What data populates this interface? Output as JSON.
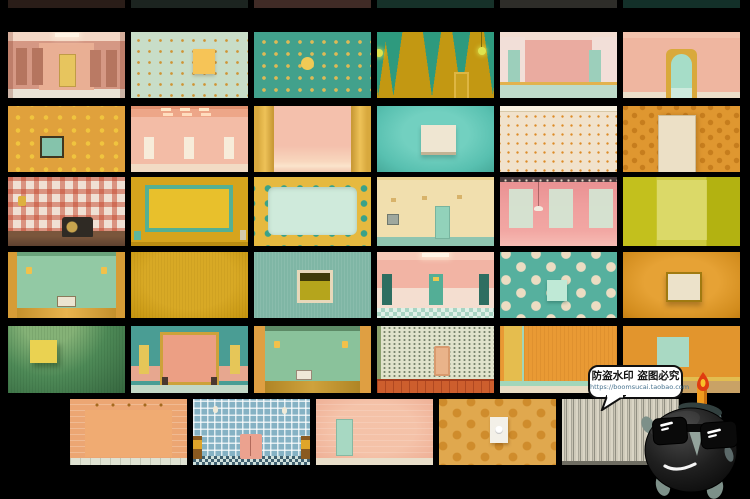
{
  "page": {
    "background": "#000000"
  },
  "watermark": {
    "line1": "防盗水印 盗图必究",
    "line2": "https://boomsucai.taobao.com",
    "bubble_fill": "#ffffff",
    "bubble_border": "#101010",
    "url_color": "#48738f"
  },
  "mascot": {
    "alt": "cartoon bomb mascot wearing sunglasses with lit candle fuse",
    "body_color": "#1e1e1e",
    "cap_color": "#5d7173",
    "limb_color": "#7d9089",
    "candle_color": "#f09b1e",
    "flame_color": "#e03c10"
  },
  "palette": {
    "background": "#000000",
    "pink": "#f2b4a4",
    "salmon": "#ec9f84",
    "mint": "#a2d6ba",
    "teal": "#42a18c",
    "mustard": "#d6a41d",
    "orange": "#df9730",
    "cream": "#efe6d2",
    "chartreuse": "#c3c01d",
    "honey": "#e0a84e"
  },
  "gallery": {
    "rows": 6,
    "columns_per_row": [
      6,
      6,
      6,
      6,
      6,
      5
    ],
    "top_cropped_slivers": 6
  },
  "tiles": [
    {
      "id": "r1c1",
      "alt": "pink hallway with yellow door",
      "colors": [
        "#d59884",
        "#e7c55e"
      ]
    },
    {
      "id": "r1c2",
      "alt": "mint wall with orange dot grid and yellow poster",
      "colors": [
        "#c8ddc8",
        "#f6c457"
      ]
    },
    {
      "id": "r1c3",
      "alt": "teal wall with yellow dots and one large dot",
      "colors": [
        "#42a18c",
        "#f0ca55"
      ]
    },
    {
      "id": "r1c4",
      "alt": "mustard wall with teal pennant triangles and hanging bulbs",
      "colors": [
        "#c39812",
        "#2e9a7e"
      ]
    },
    {
      "id": "r1c5",
      "alt": "pink room with mint doors and mint floor",
      "colors": [
        "#eaaba0",
        "#9ccfbb"
      ]
    },
    {
      "id": "r1c6",
      "alt": "peach wall with arched mint doorway in yellow frame",
      "colors": [
        "#efb6a0",
        "#a6ddc8"
      ]
    },
    {
      "id": "r2c1",
      "alt": "orange wall with yellow dots and small teal picture",
      "colors": [
        "#e0a13c",
        "#85c3ab"
      ]
    },
    {
      "id": "r2c2",
      "alt": "pink tiled room with ceiling lights and three cream doors",
      "colors": [
        "#f3bca6",
        "#f7ecda"
      ]
    },
    {
      "id": "r2c3",
      "alt": "pink stage wall with yellow side pillars",
      "colors": [
        "#f4c0ac",
        "#eec258"
      ]
    },
    {
      "id": "r2c4",
      "alt": "teal wall with blank cream frame",
      "colors": [
        "#58c0b0",
        "#efe6d2"
      ]
    },
    {
      "id": "r2c5",
      "alt": "cream wall with fine orange dot grid and cornice",
      "colors": [
        "#f1e2cc",
        "#dd8b28"
      ]
    },
    {
      "id": "r2c6",
      "alt": "orange dotted wall with cream door",
      "colors": [
        "#df9730",
        "#ece0c6"
      ]
    },
    {
      "id": "r3c1",
      "alt": "red gingham wallpaper with radio on wooden sideboard",
      "colors": [
        "#f0e0d4",
        "#2f2a24"
      ]
    },
    {
      "id": "r3c2",
      "alt": "mustard wall with teal-framed yellow noticeboard",
      "colors": [
        "#d6a41d",
        "#55b093"
      ]
    },
    {
      "id": "r3c3",
      "alt": "mint screen in yellow frame with teal dots",
      "colors": [
        "#e6b93f",
        "#cfeadb"
      ]
    },
    {
      "id": "r3c4",
      "alt": "cream wall with mint door and sconce shadows",
      "colors": [
        "#f1dfae",
        "#92d2ba"
      ]
    },
    {
      "id": "r3c5",
      "alt": "pink wall with three mint panels and hanging mobile",
      "colors": [
        "#ef9e9d",
        "#d3e6d4"
      ]
    },
    {
      "id": "r3c6",
      "alt": "chartreuse wall with pale center panel",
      "colors": [
        "#c3c01d",
        "#e4e284"
      ]
    },
    {
      "id": "r4c1",
      "alt": "mint room with amber floor, wall lamps and radio",
      "colors": [
        "#92c9a4",
        "#d69c36"
      ]
    },
    {
      "id": "r4c2",
      "alt": "plain mustard textured wall",
      "colors": [
        "#d8a925"
      ]
    },
    {
      "id": "r4c3",
      "alt": "teal wall with small olive window",
      "colors": [
        "#7fb6a5",
        "#b5a51c"
      ]
    },
    {
      "id": "r4c4",
      "alt": "pink corridor with teal doors and checkered floor",
      "colors": [
        "#f2b4a4",
        "#53ae96"
      ]
    },
    {
      "id": "r4c5",
      "alt": "teal wall with cream polka dots and mint square",
      "colors": [
        "#56b09e",
        "#bfe9d6"
      ]
    },
    {
      "id": "r4c6",
      "alt": "orange wall with cream window frame",
      "colors": [
        "#d28c1d",
        "#ece2ca"
      ]
    },
    {
      "id": "r5c1",
      "alt": "green wall with yellow canvas under lamp glow",
      "colors": [
        "#4e8a57",
        "#ead251"
      ]
    },
    {
      "id": "r5c2",
      "alt": "teal room with peach alcove and yellow doors",
      "colors": [
        "#4a9d94",
        "#ec9f84"
      ]
    },
    {
      "id": "r5c3",
      "alt": "green room with wall lamps and radio on floor",
      "colors": [
        "#8ac29b",
        "#df9f42"
      ]
    },
    {
      "id": "r5c4",
      "alt": "dotted wallpaper room with terracotta floor and peach niche",
      "colors": [
        "#e0e3cb",
        "#cd5e2d"
      ]
    },
    {
      "id": "r5c5",
      "alt": "orange wall with yellow door and mint baseboard",
      "colors": [
        "#e99a34",
        "#e5bd4e"
      ]
    },
    {
      "id": "r5c6",
      "alt": "orange wall with mint panel and yellow baseboard",
      "colors": [
        "#e2952d",
        "#a9d9c3"
      ]
    },
    {
      "id": "r6c1",
      "alt": "peach cloakroom with rows of wall hooks",
      "colors": [
        "#eca673",
        "#f0ab72"
      ]
    },
    {
      "id": "r6c2",
      "alt": "blue gingham room with pink cabinet and chairs",
      "colors": [
        "#85b2c4",
        "#eba28f"
      ]
    },
    {
      "id": "r6c3",
      "alt": "peach tiled room with mint door",
      "colors": [
        "#efb197",
        "#a7d8c2"
      ]
    },
    {
      "id": "r6c4",
      "alt": "honey wall with embossed dots and doorbell plate",
      "colors": [
        "#e0a84e",
        "#f3f0e8"
      ]
    },
    {
      "id": "r6c5",
      "alt": "striped gray wall",
      "colors": [
        "#c9c4b4"
      ]
    }
  ]
}
